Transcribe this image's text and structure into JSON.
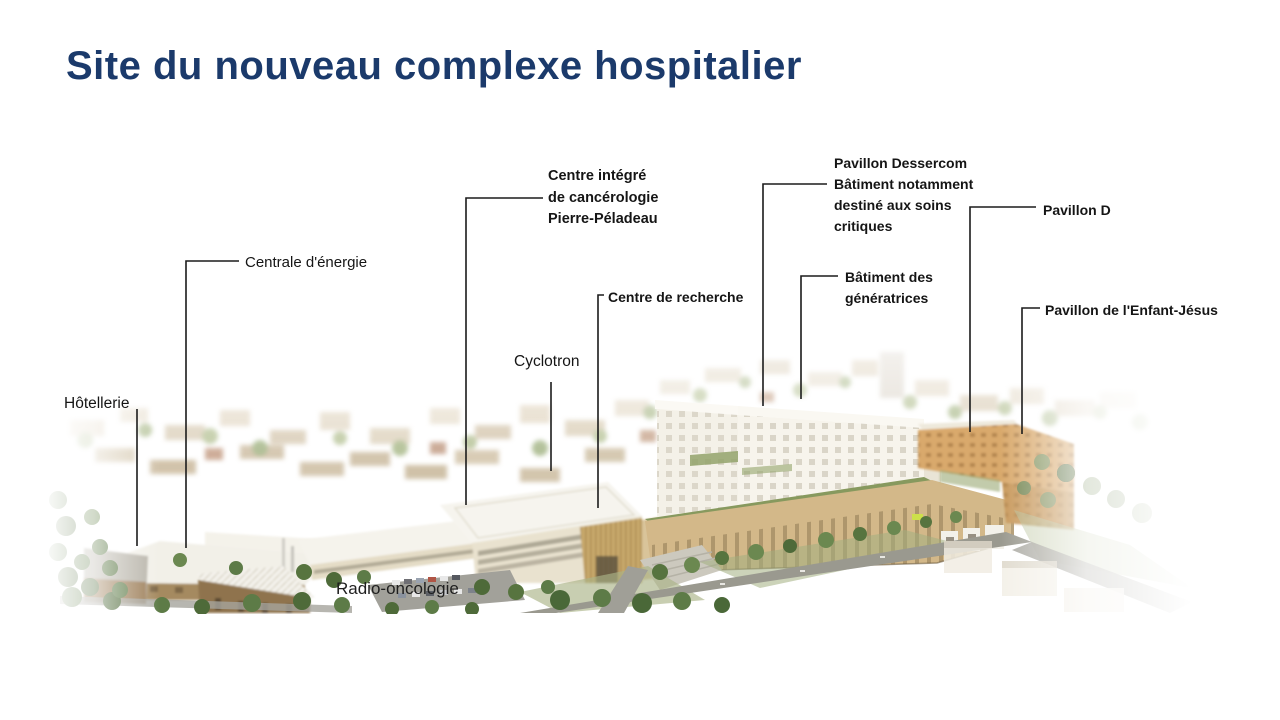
{
  "slide": {
    "title": "Site du nouveau complexe hospitalier"
  },
  "labels": {
    "centre_integre": "Centre intégré\nde cancérologie\nPierre-Péladeau",
    "pavillon_dessercom": "Pavillon Dessercom\nBâtiment notamment\ndestiné aux soins\ncritiques",
    "pavillon_d": "Pavillon D",
    "centrale_energie": "Centrale d'énergie",
    "batiment_generatrices": "Bâtiment des\ngénératrices",
    "centre_recherche": "Centre de recherche",
    "pavillon_enfant_jesus": "Pavillon de l'Enfant-Jésus",
    "cyclotron": "Cyclotron",
    "hotellerie": "Hôtellerie",
    "radio_oncologie": "Radio-oncologie"
  },
  "colors": {
    "title": "#1b3a6b",
    "label_text": "#151515",
    "leader_line": "#1c1c1c"
  }
}
